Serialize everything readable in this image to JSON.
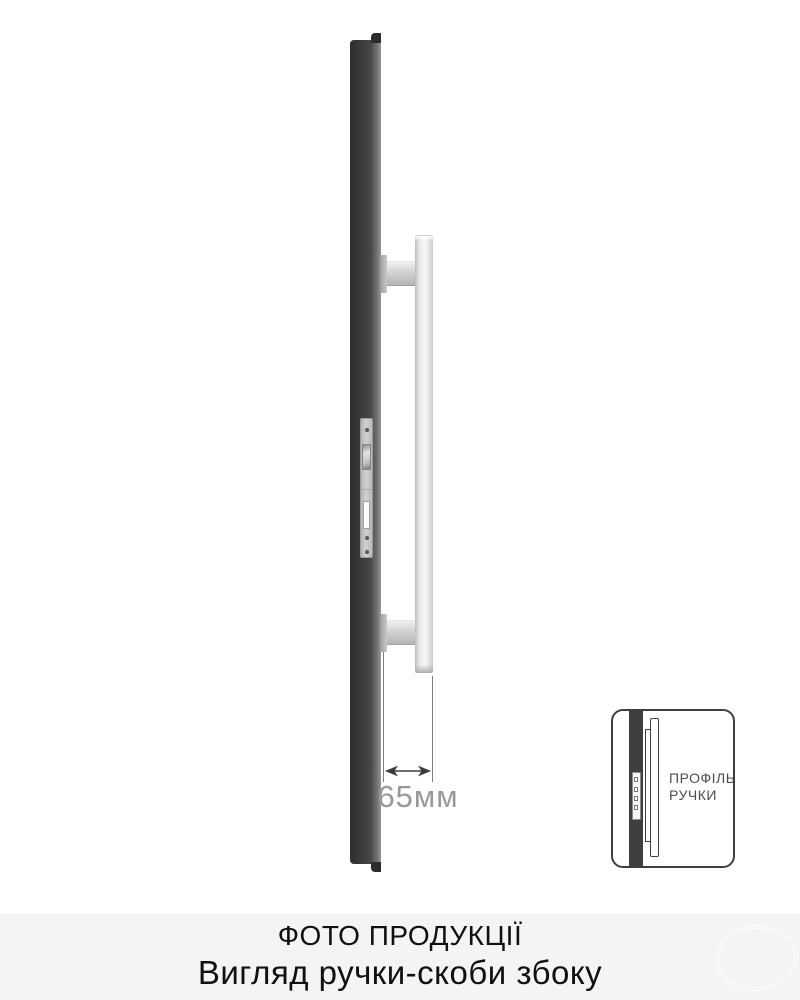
{
  "illustration": {
    "dimension": {
      "label": "65мм"
    },
    "inset": {
      "label_line1": "ПРОФІЛЬ",
      "label_line2": "РУЧКИ"
    },
    "icons": {
      "dimension_arrow": "↔"
    }
  },
  "caption": {
    "title": "ФОТО ПРОДУКЦІЇ",
    "subtitle": "Вигляд ручки-скоби збоку"
  },
  "colors": {
    "door_edge": "#3f3f3f",
    "handle_metal": "#ececec",
    "lock_plate": "#c6c6c6",
    "inset_outline": "#3e3e3e",
    "dimension_text": "#97989a",
    "caption_background": "#f4f4f5",
    "caption_text": "#111111",
    "page_background": "#ffffff"
  }
}
